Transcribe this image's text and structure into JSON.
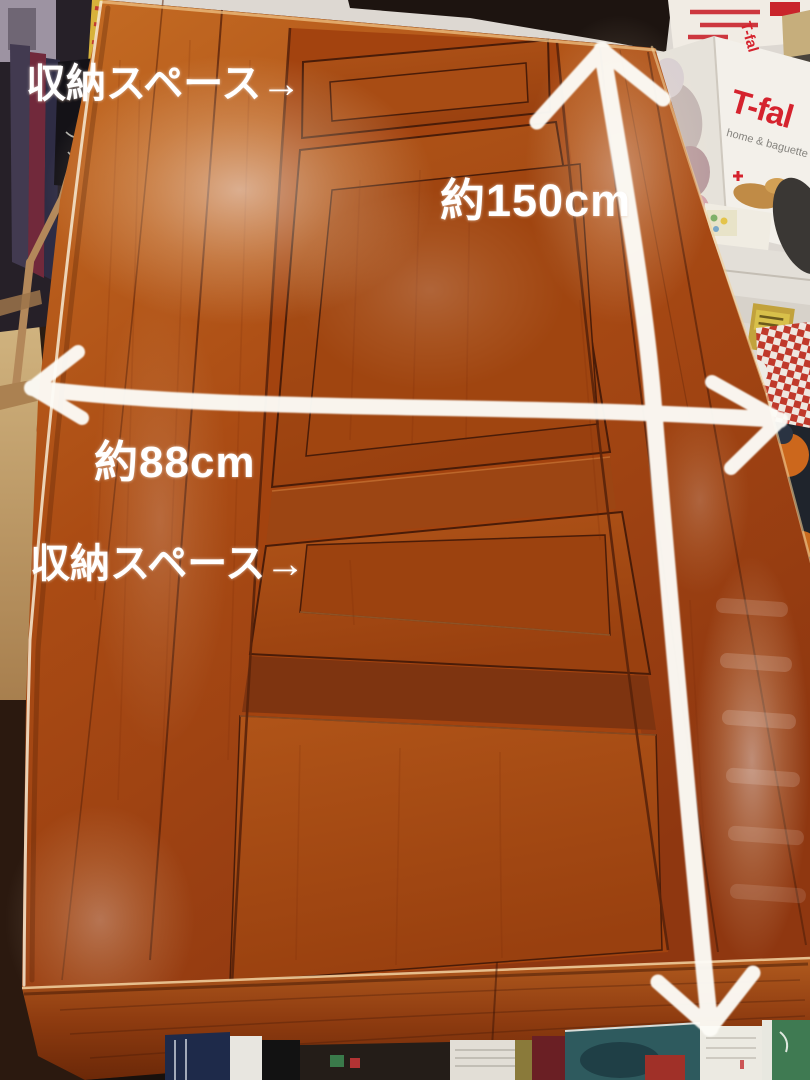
{
  "annotations": {
    "storage_labels": [
      {
        "text": "収納スペース→"
      },
      {
        "text": "収納スペース→"
      }
    ],
    "length_label": "約150cm",
    "width_label": "約88cm",
    "text_color": "#ffffff",
    "arrow_color": "#fdfcf7"
  },
  "background": {
    "tfal_box": {
      "brand": "T-fal",
      "brand_side": "T-fal",
      "tagline": "home & baguette",
      "brand_color": "#d5232e"
    }
  },
  "palette": {
    "table_wood": "#b4561a",
    "table_wood_dark": "#8a3410",
    "panel_seam": "#4a1c08",
    "floor": "#c9a870",
    "checker_red": "#c0392b"
  }
}
